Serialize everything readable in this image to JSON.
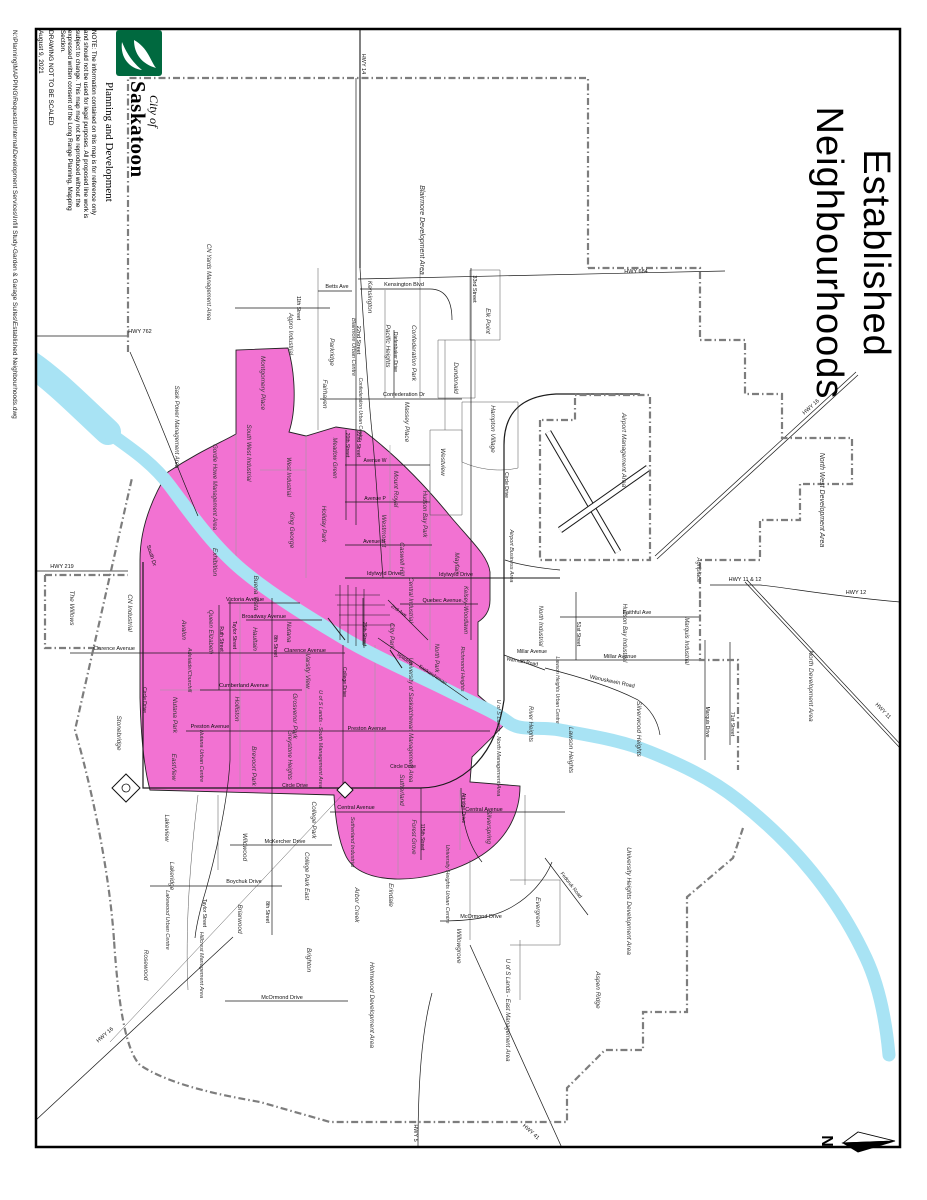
{
  "title": {
    "line1": "Established",
    "line2": "Neighbourhoods"
  },
  "logo": {
    "brand_prefix": "City of",
    "brand_name": "Saskatoon",
    "department": "Planning and Development"
  },
  "notes": {
    "note": "NOTE: The information contained on this map is for reference only and should not be used for legal purposes. All proposed line work is subject to change. This map may not be reproduced without the expressed written consent of the Long Range Planning, Mapping Section.",
    "scale_warning": "DRAWING NOT TO BE SCALED",
    "date": "August 9, 2021"
  },
  "file_path": "N:\\Planning\\MAPPING\\Requests\\Internal\\Development Services\\Infill Study-Garden & Garage Suites\\Established Neighbourhoods.dwg",
  "compass": {
    "label": "N"
  },
  "colors": {
    "established_fill": "#F272D2",
    "river": "#A8E3F4",
    "road": "#1a1a1a",
    "boundary_dash": "#7d7d7d",
    "minor_boundary": "#9b9b9b",
    "logo_green": "#00693F"
  },
  "map": {
    "area_labels": [
      {
        "t": "CN Yards Management Area",
        "x": 207,
        "y": 282,
        "a": 90,
        "s": 6
      },
      {
        "t": "Blairmore Development Area",
        "x": 420,
        "y": 230,
        "a": 90,
        "s": 7
      },
      {
        "t": "Blairmore Urban Centre",
        "x": 352,
        "y": 347,
        "a": 90,
        "s": 5.5
      },
      {
        "t": "Kensington",
        "x": 368,
        "y": 297,
        "a": 90,
        "s": 6.5
      },
      {
        "t": "Agpro Industrial",
        "x": 289,
        "y": 334,
        "a": 90,
        "s": 6
      },
      {
        "t": "Parkridge",
        "x": 330,
        "y": 352,
        "a": 90,
        "s": 6.5
      },
      {
        "t": "Pacific Heights",
        "x": 386,
        "y": 346,
        "a": 90,
        "s": 6.5
      },
      {
        "t": "Confederation Park",
        "x": 412,
        "y": 353,
        "a": 90,
        "s": 6.5
      },
      {
        "t": "Elk Point",
        "x": 486,
        "y": 321,
        "a": 90,
        "s": 6.5
      },
      {
        "t": "Dundonald",
        "x": 454,
        "y": 378,
        "a": 90,
        "s": 6.5
      },
      {
        "t": "Fairhaven",
        "x": 323,
        "y": 394,
        "a": 90,
        "s": 6.5
      },
      {
        "t": "Confederation Urban Centre",
        "x": 359,
        "y": 409,
        "a": 90,
        "s": 5
      },
      {
        "t": "Massey Place",
        "x": 405,
        "y": 422,
        "a": 90,
        "s": 6.5
      },
      {
        "t": "Westview",
        "x": 441,
        "y": 462,
        "a": 90,
        "s": 6.5
      },
      {
        "t": "Hampton Village",
        "x": 491,
        "y": 429,
        "a": 90,
        "s": 6.5
      },
      {
        "t": "Sask Power Management Area",
        "x": 175,
        "y": 427,
        "a": 90,
        "s": 6
      },
      {
        "t": "Montgomery Place",
        "x": 261,
        "y": 383,
        "a": 90,
        "s": 6.5
      },
      {
        "t": "Gordie Howe Management Area",
        "x": 213,
        "y": 487,
        "a": 90,
        "s": 6
      },
      {
        "t": "South West Industrial",
        "x": 247,
        "y": 453,
        "a": 90,
        "s": 6
      },
      {
        "t": "West Industrial",
        "x": 287,
        "y": 477,
        "a": 90,
        "s": 6
      },
      {
        "t": "Holiday Park",
        "x": 322,
        "y": 524,
        "a": 90,
        "s": 6.5
      },
      {
        "t": "King George",
        "x": 290,
        "y": 530,
        "a": 90,
        "s": 6.5
      },
      {
        "t": "Meadow Green",
        "x": 333,
        "y": 458,
        "a": 90,
        "s": 6
      },
      {
        "t": "Westmount",
        "x": 382,
        "y": 531,
        "a": 90,
        "s": 6.5
      },
      {
        "t": "Mount Royal",
        "x": 394,
        "y": 489,
        "a": 90,
        "s": 6.5
      },
      {
        "t": "Hudson Bay Park",
        "x": 423,
        "y": 514,
        "a": 90,
        "s": 6
      },
      {
        "t": "Mayfair",
        "x": 455,
        "y": 563,
        "a": 90,
        "s": 6.5
      },
      {
        "t": "Kelsey-Woodlawn",
        "x": 464,
        "y": 610,
        "a": 90,
        "s": 6
      },
      {
        "t": "Caswell Hill",
        "x": 400,
        "y": 559,
        "a": 90,
        "s": 6.5
      },
      {
        "t": "Central Industrial",
        "x": 409,
        "y": 600,
        "a": 90,
        "s": 6
      },
      {
        "t": "City Park",
        "x": 390,
        "y": 636,
        "a": 90,
        "s": 6.5
      },
      {
        "t": "North Park",
        "x": 435,
        "y": 658,
        "a": 90,
        "s": 6
      },
      {
        "t": "Richmond Heights",
        "x": 461,
        "y": 669,
        "a": 90,
        "s": 5.5
      },
      {
        "t": "Airport Business Area",
        "x": 510,
        "y": 556,
        "a": 90,
        "s": 5.5
      },
      {
        "t": "Airport Management Area",
        "x": 622,
        "y": 450,
        "a": 90,
        "s": 6.5
      },
      {
        "t": "North Industrial",
        "x": 539,
        "y": 626,
        "a": 90,
        "s": 6
      },
      {
        "t": "Hudson Bay Industrial",
        "x": 623,
        "y": 633,
        "a": 90,
        "s": 6
      },
      {
        "t": "Marquis Industrial",
        "x": 685,
        "y": 641,
        "a": 90,
        "s": 6
      },
      {
        "t": "Agriplace",
        "x": 697,
        "y": 570,
        "a": 90,
        "s": 6
      },
      {
        "t": "North West Development Area",
        "x": 820,
        "y": 500,
        "a": 90,
        "s": 7
      },
      {
        "t": "North Development Area",
        "x": 809,
        "y": 686,
        "a": 90,
        "s": 6.5
      },
      {
        "t": "Silverwood Heights",
        "x": 637,
        "y": 729,
        "a": 90,
        "s": 6.5
      },
      {
        "t": "Lawson Heights",
        "x": 569,
        "y": 750,
        "a": 90,
        "s": 6.5
      },
      {
        "t": "Lawson Heights Urban Centre",
        "x": 556,
        "y": 690,
        "a": 90,
        "s": 5
      },
      {
        "t": "River Heights",
        "x": 529,
        "y": 724,
        "a": 90,
        "s": 6
      },
      {
        "t": "U of S Lands - North Management Area",
        "x": 497,
        "y": 748,
        "a": 90,
        "s": 5.5
      },
      {
        "t": "University of Saskatchewan Management Area",
        "x": 409,
        "y": 720,
        "a": 90,
        "s": 6
      },
      {
        "t": "Sutherland",
        "x": 400,
        "y": 790,
        "a": 90,
        "s": 6.5
      },
      {
        "t": "Sutherland Industrial",
        "x": 351,
        "y": 842,
        "a": 90,
        "s": 5.5
      },
      {
        "t": "Forest Grove",
        "x": 412,
        "y": 837,
        "a": 90,
        "s": 6
      },
      {
        "t": "Silverspring",
        "x": 487,
        "y": 827,
        "a": 90,
        "s": 6.5
      },
      {
        "t": "University Heights Urban Centre",
        "x": 446,
        "y": 884,
        "a": 90,
        "s": 5.5
      },
      {
        "t": "University Heights Development Area",
        "x": 627,
        "y": 901,
        "a": 90,
        "s": 6.5
      },
      {
        "t": "Evergreen",
        "x": 536,
        "y": 912,
        "a": 90,
        "s": 6.5
      },
      {
        "t": "Willowgrove",
        "x": 457,
        "y": 946,
        "a": 90,
        "s": 6.5
      },
      {
        "t": "Erindale",
        "x": 389,
        "y": 895,
        "a": 90,
        "s": 6.5
      },
      {
        "t": "Arbor Creek",
        "x": 355,
        "y": 905,
        "a": 90,
        "s": 6.5
      },
      {
        "t": "College Park",
        "x": 312,
        "y": 820,
        "a": 90,
        "s": 6.5
      },
      {
        "t": "College Park East",
        "x": 305,
        "y": 876,
        "a": 90,
        "s": 6
      },
      {
        "t": "Brighton",
        "x": 307,
        "y": 960,
        "a": 90,
        "s": 6.5
      },
      {
        "t": "Holmwood Development Area",
        "x": 370,
        "y": 1005,
        "a": 90,
        "s": 6.5
      },
      {
        "t": "U of S Lands - East Management Area",
        "x": 506,
        "y": 1010,
        "a": 90,
        "s": 6
      },
      {
        "t": "Aspen Ridge",
        "x": 596,
        "y": 990,
        "a": 90,
        "s": 6.5
      },
      {
        "t": "Hillcrest Management Area",
        "x": 200,
        "y": 965,
        "a": 90,
        "s": 5.5
      },
      {
        "t": "Rosewood",
        "x": 144,
        "y": 965,
        "a": 90,
        "s": 6.5
      },
      {
        "t": "Lakewood Urban Centre",
        "x": 166,
        "y": 920,
        "a": 90,
        "s": 5.5
      },
      {
        "t": "Lakeridge",
        "x": 170,
        "y": 876,
        "a": 90,
        "s": 6.5
      },
      {
        "t": "Lakeview",
        "x": 165,
        "y": 828,
        "a": 90,
        "s": 6.5
      },
      {
        "t": "Stonebridge",
        "x": 117,
        "y": 733,
        "a": 90,
        "s": 6.5
      },
      {
        "t": "Wildwood",
        "x": 243,
        "y": 847,
        "a": 90,
        "s": 6.5
      },
      {
        "t": "Briarwood",
        "x": 238,
        "y": 919,
        "a": 90,
        "s": 6.5
      },
      {
        "t": "EastView",
        "x": 172,
        "y": 767,
        "a": 90,
        "s": 6.5
      },
      {
        "t": "Nutana Park",
        "x": 173,
        "y": 715,
        "a": 90,
        "s": 6.5
      },
      {
        "t": "Nutana Urban Centre",
        "x": 200,
        "y": 756,
        "a": 90,
        "s": 5.5
      },
      {
        "t": "Adelaide/Churchill",
        "x": 188,
        "y": 670,
        "a": 90,
        "s": 5.5
      },
      {
        "t": "Avalon",
        "x": 182,
        "y": 630,
        "a": 90,
        "s": 6.5
      },
      {
        "t": "Queen Elizabeth",
        "x": 209,
        "y": 632,
        "a": 90,
        "s": 6
      },
      {
        "t": "Exhibition",
        "x": 213,
        "y": 562,
        "a": 90,
        "s": 6.5
      },
      {
        "t": "Buena Vista",
        "x": 254,
        "y": 593,
        "a": 90,
        "s": 6.5
      },
      {
        "t": "Haultain",
        "x": 253,
        "y": 639,
        "a": 90,
        "s": 6.5
      },
      {
        "t": "Nutana",
        "x": 287,
        "y": 632,
        "a": 90,
        "s": 6.5
      },
      {
        "t": "Varsity View",
        "x": 306,
        "y": 671,
        "a": 90,
        "s": 6.5
      },
      {
        "t": "Holliston",
        "x": 235,
        "y": 709,
        "a": 90,
        "s": 6.5
      },
      {
        "t": "Grosvenor Park",
        "x": 293,
        "y": 716,
        "a": 90,
        "s": 6.5
      },
      {
        "t": "Greystone Heights",
        "x": 288,
        "y": 755,
        "a": 90,
        "s": 6
      },
      {
        "t": "Brevoort Park",
        "x": 252,
        "y": 766,
        "a": 90,
        "s": 6.5
      },
      {
        "t": "U of S Lands - South Management Area",
        "x": 319,
        "y": 739,
        "a": 90,
        "s": 5.5
      },
      {
        "t": "The Willows",
        "x": 70,
        "y": 608,
        "a": 90,
        "s": 6.5
      },
      {
        "t": "CN Industrial",
        "x": 128,
        "y": 613,
        "a": 90,
        "s": 6.5
      }
    ],
    "road_labels": [
      {
        "t": "HWY 762",
        "x": 140,
        "y": 333,
        "a": 0,
        "s": 5.5
      },
      {
        "t": "HWY 219",
        "x": 62,
        "y": 568,
        "a": 0,
        "s": 5.5
      },
      {
        "t": "HWY 14",
        "x": 362,
        "y": 64,
        "a": 90,
        "s": 5.5
      },
      {
        "t": "HWY 684",
        "x": 636,
        "y": 273,
        "a": 0,
        "s": 5.5
      },
      {
        "t": "HWY 11 & 12",
        "x": 745,
        "y": 581,
        "a": 0,
        "s": 5.5
      },
      {
        "t": "HWY 12",
        "x": 856,
        "y": 594,
        "a": 0,
        "s": 5.5
      },
      {
        "t": "HWY 16",
        "x": 812,
        "y": 408,
        "a": -42,
        "s": 5.5
      },
      {
        "t": "HWY 11",
        "x": 882,
        "y": 712,
        "a": 46,
        "s": 5.5
      },
      {
        "t": "HWY 16",
        "x": 106,
        "y": 1036,
        "a": -41,
        "s": 5.5
      },
      {
        "t": "HWY 5",
        "x": 414,
        "y": 1133,
        "a": 90,
        "s": 5.5
      },
      {
        "t": "HWY 41",
        "x": 530,
        "y": 1133,
        "a": 42,
        "s": 5.5
      },
      {
        "t": "Betts Ave",
        "x": 337,
        "y": 288,
        "a": 0,
        "s": 5.5
      },
      {
        "t": "Kensington Blvd",
        "x": 404,
        "y": 286,
        "a": 0,
        "s": 5.5
      },
      {
        "t": "22nd Street",
        "x": 357,
        "y": 340,
        "a": 90,
        "s": 5.5
      },
      {
        "t": "33rd Street",
        "x": 473,
        "y": 289,
        "a": 90,
        "s": 5.5
      },
      {
        "t": "Confederation Dr",
        "x": 404,
        "y": 396,
        "a": 0,
        "s": 5.5
      },
      {
        "t": "Diefenbaker Drive",
        "x": 394,
        "y": 352,
        "a": 90,
        "s": 5
      },
      {
        "t": "20th Street",
        "x": 346,
        "y": 445,
        "a": 90,
        "s": 5
      },
      {
        "t": "22nd Street",
        "x": 357,
        "y": 444,
        "a": 90,
        "s": 5
      },
      {
        "t": "Idylwyld Drive",
        "x": 384,
        "y": 575,
        "a": 0,
        "s": 5.5
      },
      {
        "t": "Idylwyld Drive",
        "x": 456,
        "y": 576,
        "a": 0,
        "s": 5.5
      },
      {
        "t": "Quebec Avenue",
        "x": 442,
        "y": 602,
        "a": 0,
        "s": 5.5
      },
      {
        "t": "2nd Ave",
        "x": 398,
        "y": 612,
        "a": 35,
        "s": 5
      },
      {
        "t": "25th Street",
        "x": 363,
        "y": 634,
        "a": 90,
        "s": 5
      },
      {
        "t": "Spadina",
        "x": 404,
        "y": 660,
        "a": 35,
        "s": 5
      },
      {
        "t": "Victoria Avenue",
        "x": 245,
        "y": 601,
        "a": 0,
        "s": 5.5
      },
      {
        "t": "Broadway Avenue",
        "x": 264,
        "y": 618,
        "a": 0,
        "s": 5.5
      },
      {
        "t": "Clarence Avenue",
        "x": 114,
        "y": 650,
        "a": 0,
        "s": 5.5
      },
      {
        "t": "Clarence Avenue",
        "x": 305,
        "y": 652,
        "a": 0,
        "s": 5.5
      },
      {
        "t": "Cumberland Avenue",
        "x": 244,
        "y": 687,
        "a": 0,
        "s": 5.5
      },
      {
        "t": "Preston Avenue",
        "x": 210,
        "y": 728,
        "a": 0,
        "s": 5.5
      },
      {
        "t": "Preston Avenue",
        "x": 367,
        "y": 730,
        "a": 0,
        "s": 5.5
      },
      {
        "t": "8th Street",
        "x": 274,
        "y": 646,
        "a": 90,
        "s": 5
      },
      {
        "t": "8th Street",
        "x": 266,
        "y": 912,
        "a": 90,
        "s": 5
      },
      {
        "t": "Taylor Street",
        "x": 233,
        "y": 635,
        "a": 90,
        "s": 5
      },
      {
        "t": "Taylor Street",
        "x": 203,
        "y": 913,
        "a": 90,
        "s": 5
      },
      {
        "t": "Ruth Street",
        "x": 220,
        "y": 639,
        "a": 90,
        "s": 5
      },
      {
        "t": "Circle Drive",
        "x": 143,
        "y": 700,
        "a": 90,
        "s": 5
      },
      {
        "t": "Circle Drive",
        "x": 295,
        "y": 787,
        "a": 0,
        "s": 5
      },
      {
        "t": "Circle Drive",
        "x": 403,
        "y": 768,
        "a": 0,
        "s": 5
      },
      {
        "t": "Circle Drive",
        "x": 505,
        "y": 485,
        "a": 90,
        "s": 5
      },
      {
        "t": "College Drive",
        "x": 343,
        "y": 682,
        "a": 90,
        "s": 5
      },
      {
        "t": "McKercher Drive",
        "x": 285,
        "y": 843,
        "a": 0,
        "s": 5.5
      },
      {
        "t": "Boychuk Drive",
        "x": 244,
        "y": 883,
        "a": 0,
        "s": 5.5
      },
      {
        "t": "McOrmond Drive",
        "x": 481,
        "y": 918,
        "a": 0,
        "s": 5.5
      },
      {
        "t": "McOrmond Drive",
        "x": 282,
        "y": 999,
        "a": 0,
        "s": 5.5
      },
      {
        "t": "Central Avenue",
        "x": 356,
        "y": 809,
        "a": 0,
        "s": 5.5
      },
      {
        "t": "Central Avenue",
        "x": 484,
        "y": 811,
        "a": 0,
        "s": 5.5
      },
      {
        "t": "Attridge Drive",
        "x": 462,
        "y": 808,
        "a": 90,
        "s": 5
      },
      {
        "t": "115th Street",
        "x": 421,
        "y": 837,
        "a": 90,
        "s": 5
      },
      {
        "t": "Faithful Ave",
        "x": 637,
        "y": 614,
        "a": 0,
        "s": 5.5
      },
      {
        "t": "Millar Avenue",
        "x": 620,
        "y": 658,
        "a": 0,
        "s": 5.5
      },
      {
        "t": "Millar Avenue",
        "x": 532,
        "y": 653,
        "a": 0,
        "s": 5
      },
      {
        "t": "Wanuskewin Road",
        "x": 612,
        "y": 683,
        "a": 12,
        "s": 5.5
      },
      {
        "t": "Warman Road",
        "x": 522,
        "y": 663,
        "a": 10,
        "s": 5
      },
      {
        "t": "Marquis Drive",
        "x": 706,
        "y": 722,
        "a": 90,
        "s": 5
      },
      {
        "t": "71st Street",
        "x": 731,
        "y": 724,
        "a": 90,
        "s": 5
      },
      {
        "t": "51st Street",
        "x": 577,
        "y": 634,
        "a": 90,
        "s": 5
      },
      {
        "t": "Avenue W",
        "x": 375,
        "y": 462,
        "a": 0,
        "s": 5
      },
      {
        "t": "Avenue P",
        "x": 375,
        "y": 500,
        "a": 0,
        "s": 5
      },
      {
        "t": "Avenue H",
        "x": 374,
        "y": 543,
        "a": 0,
        "s": 5
      },
      {
        "t": "Fedoruk Road",
        "x": 570,
        "y": 886,
        "a": 52,
        "s": 5
      },
      {
        "t": "South Dr",
        "x": 150,
        "y": 556,
        "a": 72,
        "s": 5.5
      },
      {
        "t": "11th Street",
        "x": 297,
        "y": 308,
        "a": 90,
        "s": 5
      }
    ],
    "river_label": {
      "t": "Saskatchewan",
      "x": 432,
      "y": 676,
      "a": 33,
      "s": 5,
      "f": "#ffffff"
    }
  }
}
